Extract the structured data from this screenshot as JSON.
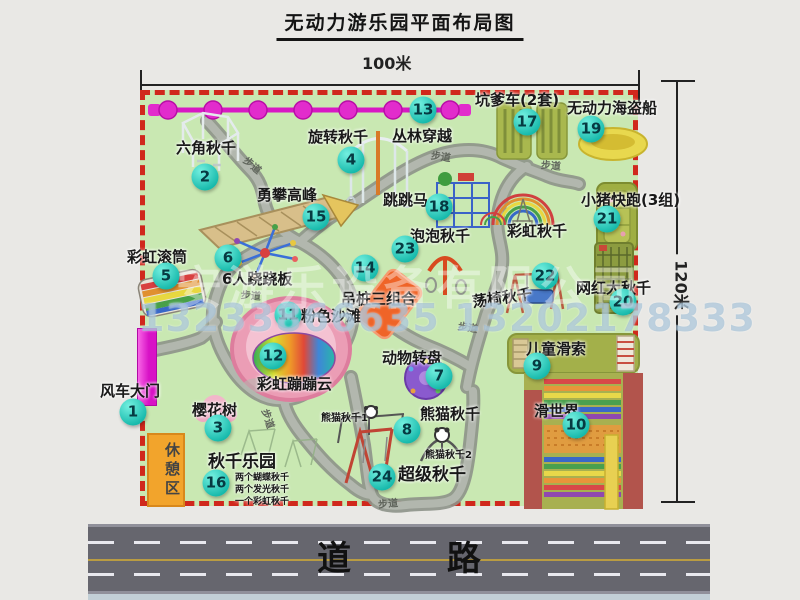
{
  "title": "无动力游乐园平面布局图",
  "dimensions": {
    "width_label": "100米",
    "height_label": "120米"
  },
  "road": {
    "label": "道 路"
  },
  "watermark": {
    "company": "安游乐设备有限公司",
    "phones": "13233866635 13202178333"
  },
  "colors": {
    "map_green": "#c9e8b2",
    "border_red": "#d0281c",
    "badge_teal": "#16b9ab",
    "path_gray": "#a0a59d",
    "road_gray": "#66666e",
    "gate_magenta": "#d812c6",
    "rest_orange": "#f2a42c",
    "chain_magenta": "#d818c4"
  },
  "map": {
    "rest_area_label": "休憩区",
    "features": [
      {
        "n": 1,
        "label": "风车大门",
        "bx": -12,
        "by": 317,
        "lx": -45,
        "ly": 285
      },
      {
        "n": 2,
        "label": "六角秋千",
        "bx": 60,
        "by": 82,
        "lx": 31,
        "ly": 42
      },
      {
        "n": 3,
        "label": "樱花树",
        "bx": 73,
        "by": 333,
        "lx": 47,
        "ly": 304
      },
      {
        "n": 4,
        "label": "旋转秋千",
        "bx": 206,
        "by": 65,
        "lx": 163,
        "ly": 31
      },
      {
        "n": 5,
        "label": "彩虹滚筒",
        "bx": 21,
        "by": 181,
        "lx": -18,
        "ly": 151
      },
      {
        "n": 6,
        "label": "6人跷跷板",
        "bx": 83,
        "by": 163,
        "lx": 77,
        "ly": 173
      },
      {
        "n": 7,
        "label": "动物转盘",
        "bx": 294,
        "by": 281,
        "lx": 237,
        "ly": 252
      },
      {
        "n": 8,
        "label": "熊猫秋千",
        "bx": 262,
        "by": 335,
        "lx": 275,
        "ly": 308
      },
      {
        "n": 9,
        "label": "儿童滑索",
        "bx": 392,
        "by": 271,
        "lx": 381,
        "ly": 243
      },
      {
        "n": 10,
        "label": "滑世界",
        "bx": 431,
        "by": 330,
        "lx": 389,
        "ly": 305
      },
      {
        "n": 11,
        "label": "粉色沙滩",
        "bx": 143,
        "by": 220,
        "lx": 156,
        "ly": 210
      },
      {
        "n": 12,
        "label": "彩虹蹦蹦云",
        "bx": 128,
        "by": 261,
        "lx": 112,
        "ly": 278
      },
      {
        "n": 13,
        "label": "丛林穿越",
        "bx": 278,
        "by": 15,
        "lx": 247,
        "ly": 30
      },
      {
        "n": 14,
        "label": "吊桩三组合",
        "bx": 220,
        "by": 173,
        "lx": 196,
        "ly": 193
      },
      {
        "n": 15,
        "label": "勇攀高峰",
        "bx": 171,
        "by": 122,
        "lx": 112,
        "ly": 89
      },
      {
        "n": 16,
        "label": "秋千乐园",
        "bx": 71,
        "by": 388,
        "lx": 63,
        "ly": 352,
        "fs": 17
      },
      {
        "n": 17,
        "label": "坑爹车(2套)",
        "bx": 382,
        "by": 27,
        "lx": 330,
        "ly": -6
      },
      {
        "n": 18,
        "label": "跳跳马",
        "bx": 294,
        "by": 112,
        "lx": 238,
        "ly": 94
      },
      {
        "n": 19,
        "label": "无动力海盗船",
        "bx": 446,
        "by": 34,
        "lx": 422,
        "ly": 2
      },
      {
        "n": 20,
        "label": "网红大秋千",
        "bx": 478,
        "by": 207,
        "lx": 431,
        "ly": 182
      },
      {
        "n": 21,
        "label": "小猪快跑(3组)",
        "bx": 462,
        "by": 124,
        "lx": 436,
        "ly": 94
      },
      {
        "n": 22,
        "label": "荡椅秋千",
        "bx": 400,
        "by": 181,
        "lx": 327,
        "ly": 192,
        "rot": -8
      },
      {
        "n": 23,
        "label": "泡泡秋千",
        "bx": 260,
        "by": 154,
        "lx": 265,
        "ly": 130
      },
      {
        "n": 24,
        "label": "超级秋千",
        "bx": 237,
        "by": 382,
        "lx": 253,
        "ly": 365,
        "fs": 17
      },
      {
        "label": "彩虹秋千",
        "lx": 362,
        "ly": 125
      },
      {
        "label": "熊猫秋千1",
        "lx": 176,
        "ly": 314,
        "fs": 10
      },
      {
        "label": "熊猫秋千2",
        "lx": 280,
        "ly": 351,
        "fs": 10
      },
      {
        "label": "两个蝴蝶秋千",
        "lx": 90,
        "ly": 375,
        "fs": 9
      },
      {
        "label": "两个发光秋千",
        "lx": 90,
        "ly": 387,
        "fs": 9
      },
      {
        "label": "一个彩虹秋千",
        "lx": 90,
        "ly": 399,
        "fs": 9
      }
    ],
    "path_labels": [
      {
        "t": "步道",
        "x": 98,
        "y": 62,
        "rot": 40
      },
      {
        "t": "步道",
        "x": 286,
        "y": 53,
        "rot": 8
      },
      {
        "t": "步道",
        "x": 396,
        "y": 62,
        "rot": 5
      },
      {
        "t": "步道",
        "x": 96,
        "y": 192,
        "rot": 5
      },
      {
        "t": "步道",
        "x": 313,
        "y": 224,
        "rot": 10
      },
      {
        "t": "步道",
        "x": 114,
        "y": 316,
        "rot": 72
      },
      {
        "t": "步道",
        "x": 233,
        "y": 400,
        "rot": -5
      }
    ]
  }
}
